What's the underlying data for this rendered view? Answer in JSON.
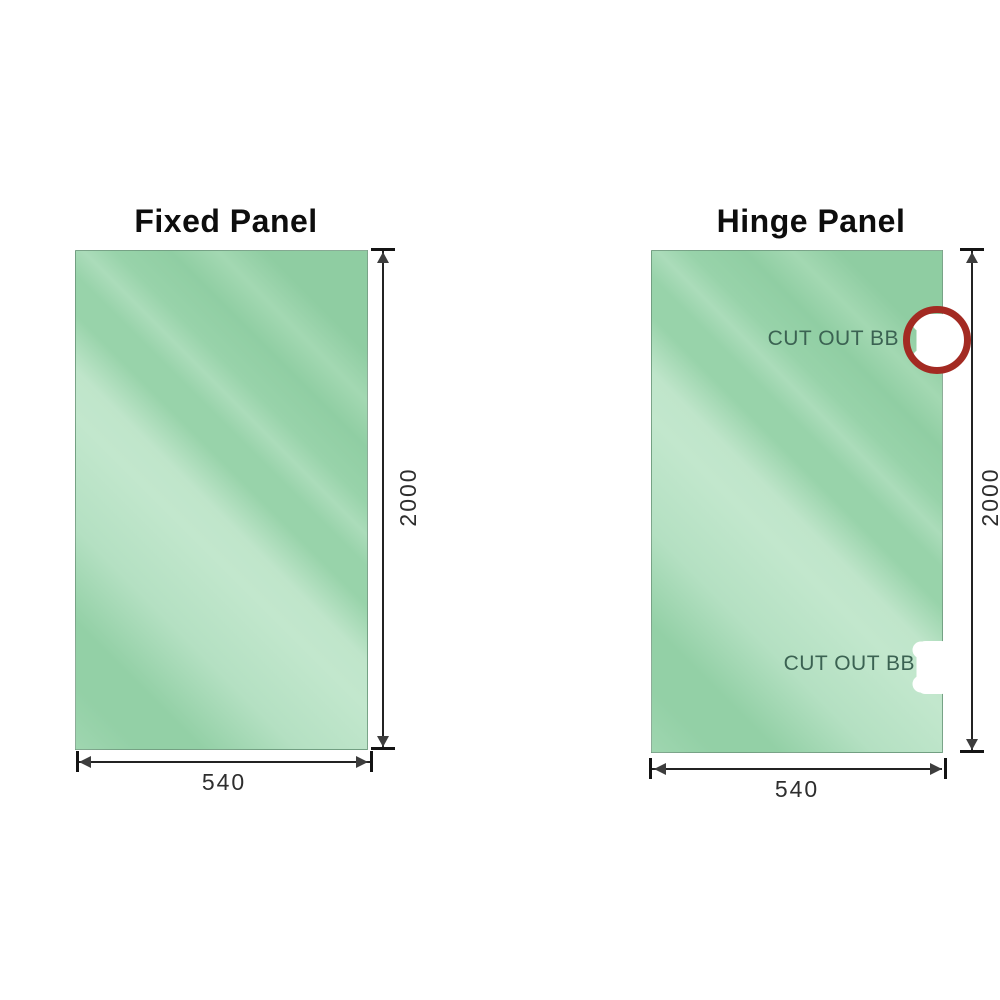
{
  "diagram": {
    "panels": [
      {
        "title": "Fixed Panel",
        "width_mm": "540",
        "height_mm": "2000",
        "cutouts": []
      },
      {
        "title": "Hinge Panel",
        "width_mm": "540",
        "height_mm": "2000",
        "cutouts": [
          {
            "label": "CUT OUT BB",
            "circled": true
          },
          {
            "label": "CUT OUT BB",
            "circled": false
          }
        ]
      }
    ],
    "colors": {
      "glass_base": "#98d3aa",
      "glass_highlight": "#c2e7cd",
      "glass_shade": "#8fcda2",
      "highlight_ring": "#a32a22",
      "cutout_label_text": "#3b6252",
      "dimension_ink": "#232323"
    }
  }
}
